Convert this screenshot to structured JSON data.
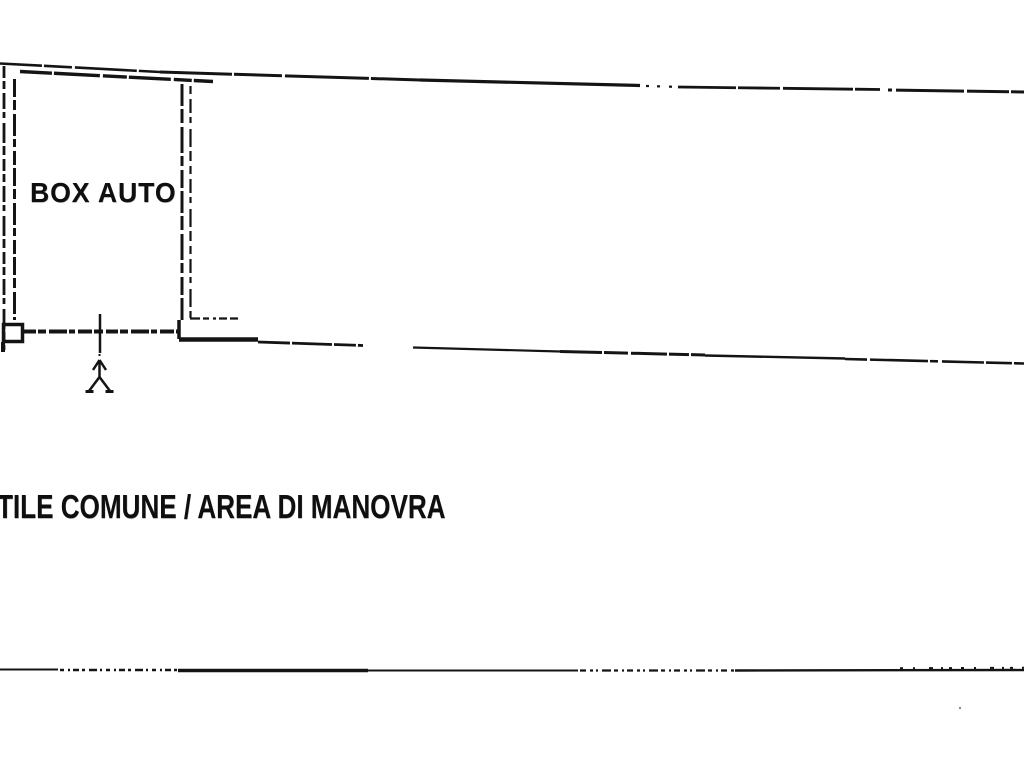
{
  "plan": {
    "room_label": "BOX AUTO",
    "area_label": "TILE COMUNE / AREA DI MANOVRA"
  },
  "icons": {
    "access_arrow": "access-direction-up-arrow"
  },
  "colors": {
    "background": "#ffffff",
    "ink": "#141414"
  }
}
